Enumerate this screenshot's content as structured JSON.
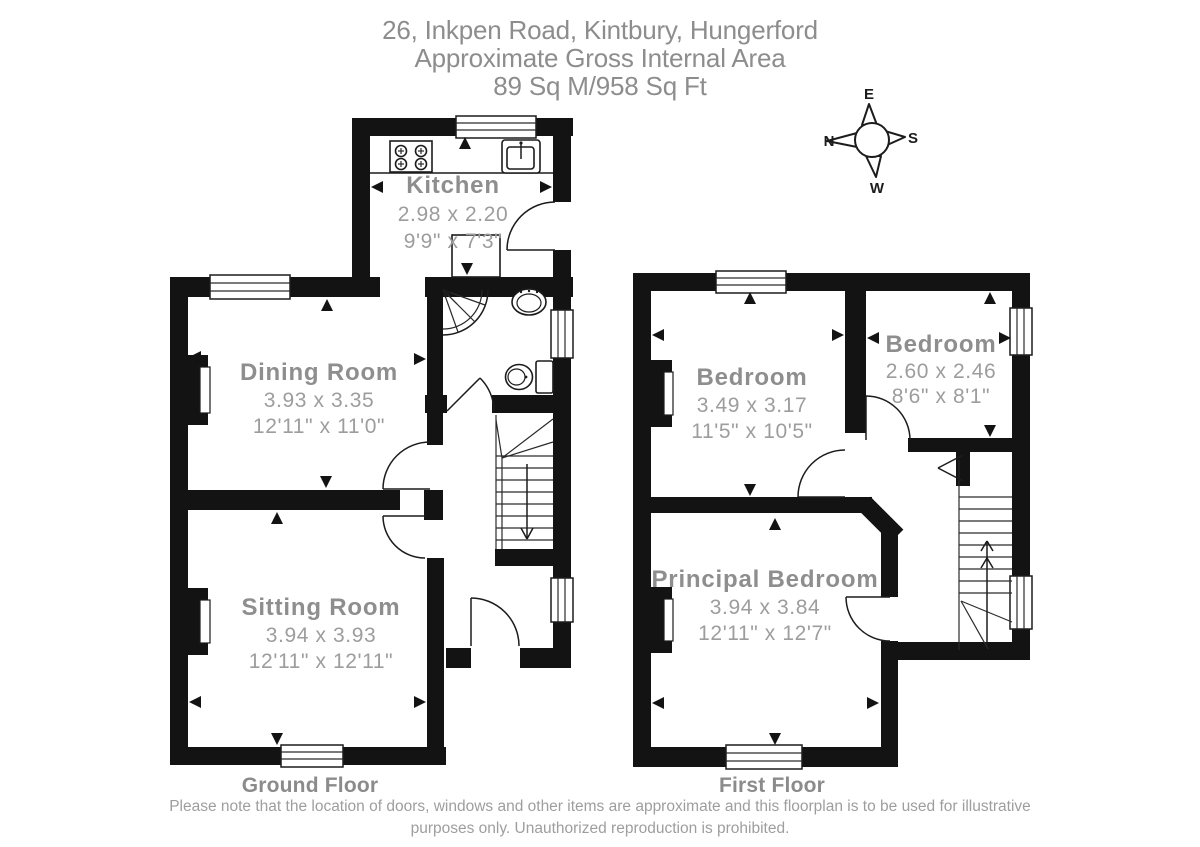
{
  "header": {
    "address": "26, Inkpen Road, Kintbury, Hungerford",
    "subtitle": "Approximate Gross Internal Area",
    "area": "89 Sq M/958 Sq Ft"
  },
  "compass": {
    "top": "E",
    "right": "S",
    "bottom": "W",
    "left": "N"
  },
  "floors": {
    "ground": {
      "label": "Ground Floor",
      "rooms": {
        "kitchen": {
          "name": "Kitchen",
          "metric": "2.98 x 2.20",
          "imperial": "9'9\" x 7'3\""
        },
        "dining": {
          "name": "Dining Room",
          "metric": "3.93 x 3.35",
          "imperial": "12'11\" x 11'0\""
        },
        "sitting": {
          "name": "Sitting Room",
          "metric": "3.94 x 3.93",
          "imperial": "12'11\" x 12'11\""
        }
      }
    },
    "first": {
      "label": "First Floor",
      "rooms": {
        "bedroom1": {
          "name": "Bedroom",
          "metric": "3.49 x 3.17",
          "imperial": "11'5\" x 10'5\""
        },
        "bedroom2": {
          "name": "Bedroom",
          "metric": "2.60 x 2.46",
          "imperial": "8'6\" x 8'1\""
        },
        "principal": {
          "name": "Principal Bedroom",
          "metric": "3.94 x 3.84",
          "imperial": "12'11\" x 12'7\""
        }
      }
    }
  },
  "footer": {
    "disclaimer_line1": "Please note that the location of doors, windows and other items are approximate and this floorplan is to be used for illustrative",
    "disclaimer_line2": "purposes only. Unauthorized reproduction is prohibited."
  },
  "colors": {
    "wall": "#131313",
    "room_text": "#8e8e8e",
    "dim_text": "#9d9d9d",
    "background": "#ffffff"
  }
}
